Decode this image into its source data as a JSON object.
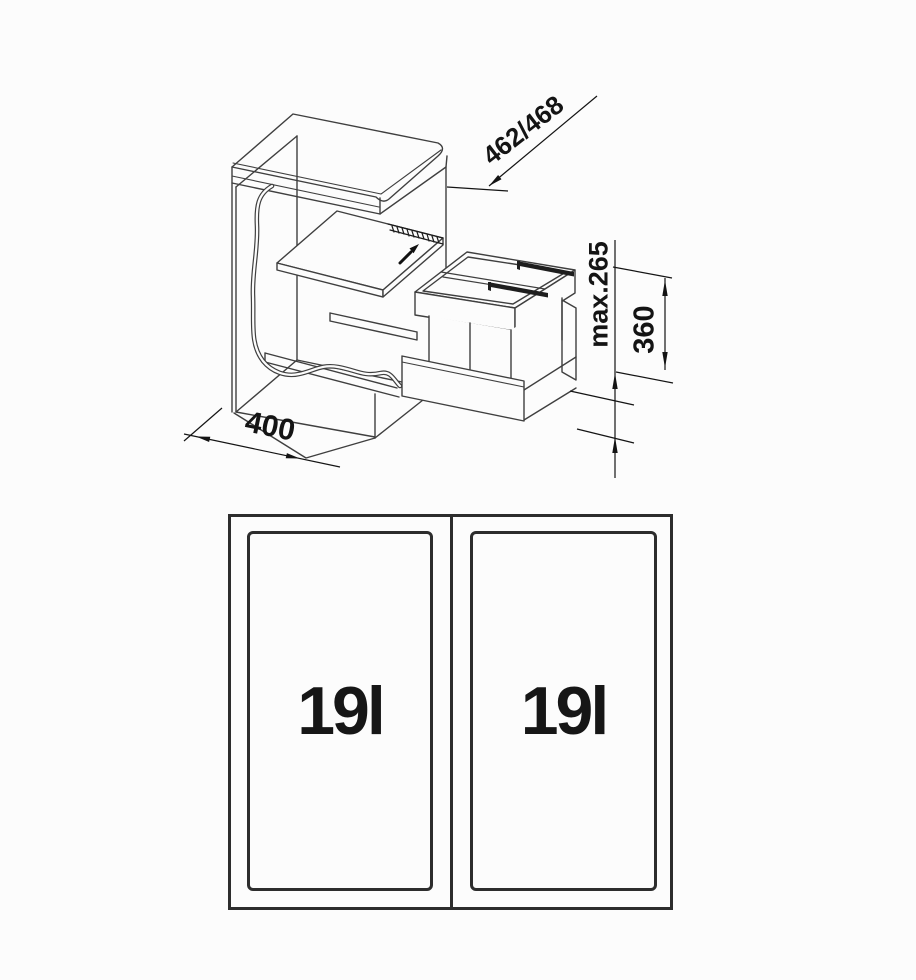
{
  "page": {
    "background": "#fcfcfc",
    "line_color": "#3f3f3f",
    "dim_color": "#141414"
  },
  "iso_view": {
    "description": "isometric cabinet with pull-out cover board and twin waste-bin frame",
    "dims": {
      "depth": "462/468",
      "height_max": "max.265",
      "unit_height": "360",
      "width": "400"
    },
    "icons": [
      "slide-direction-arrow"
    ]
  },
  "plan_view": {
    "bins": [
      {
        "capacity": "19l"
      },
      {
        "capacity": "19l"
      }
    ]
  }
}
